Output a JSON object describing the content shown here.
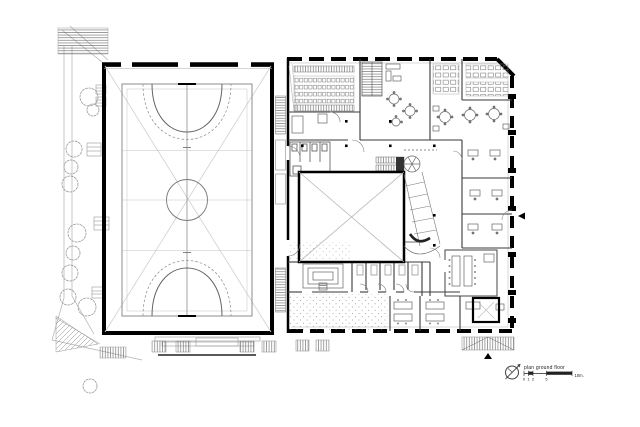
{
  "document": {
    "kind": "architectural floor plan drawing"
  },
  "legend": {
    "title": "plan ground floor",
    "compass_icon": "north-arrow-icon",
    "scale_ticks": [
      "0",
      "1",
      "2",
      "5"
    ],
    "scale_end_label": "10m."
  },
  "colors": {
    "paper": "#ffffff",
    "wall_ink": "#000000",
    "mid_ink": "#555555",
    "light_ink": "#aaaaaa"
  }
}
